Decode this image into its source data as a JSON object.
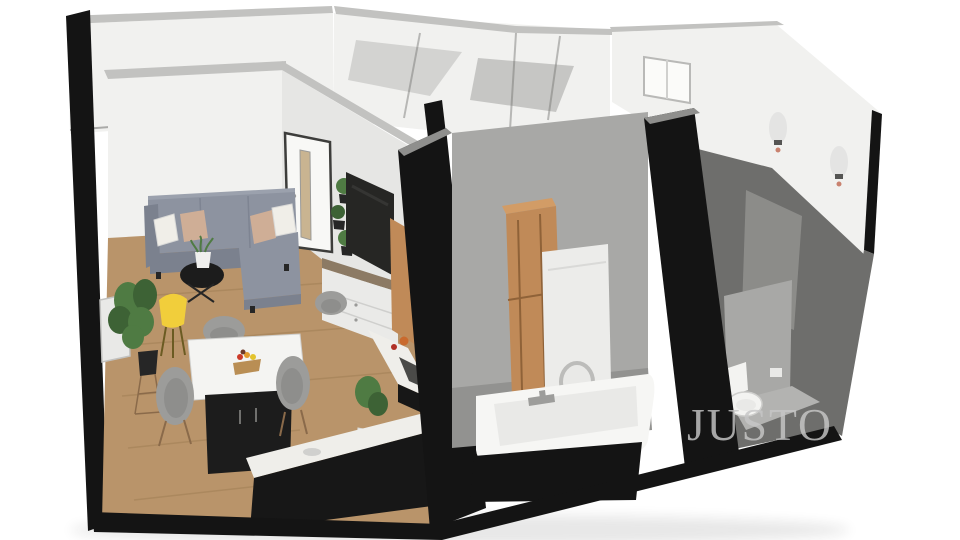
{
  "watermark": {
    "text": "JUSTO"
  },
  "palette": {
    "background": "#ffffff",
    "shadow_color": "#1a1a1a",
    "cut_black": "#141414",
    "wall_white": "#f1f1ef",
    "wall_white2": "#e6e6e4",
    "wall_top": "#c2c2c0",
    "wall_seam": "#70706e",
    "shadow_a": "#d3d3d1",
    "shadow_b": "#c6c6c4",
    "concrete_light": "#a8a8a6",
    "concrete_mid": "#8f8f8d",
    "concrete_dark": "#6e6e6c",
    "floor_wood": "#b9946a",
    "plank": "#9b7a50",
    "floor_gray": "#929290",
    "floor_gray_light": "#b3b3b1",
    "sofa": "#8d93a0",
    "sofa_dark": "#7b818e",
    "sofa_light": "#9ba1ad",
    "pillow_white": "#f0eee8",
    "pillow_tan": "#cfae96",
    "table_black": "#1c1c1c",
    "top_white": "#f4f4f2",
    "chair": "#9c9c9a",
    "chair_inner": "#8e8e8c",
    "leg_brown": "#8a6a4a",
    "lamp_yellow": "#f1ce3b",
    "lamp_leg": "#6b5b22",
    "plant": "#4f7b43",
    "plant_dark": "#3d6235",
    "pot_black": "#262626",
    "pot_white": "#efefed",
    "frame_light": "#e9e9e7",
    "door_white": "#f8f8f6",
    "door_frame": "#3d3d3b",
    "door_glass": "#c9b491",
    "tv": "#262624",
    "tv_sheen": "#3f3f3d",
    "dresser": "#eaeae8",
    "dresser_wood": "#8c7a64",
    "drawer_line": "#cfcfcd",
    "counter_white": "#efeeea",
    "counter_black": "#171717",
    "stove": "#4a4a48",
    "kettle": "#c96a2e",
    "jar_red": "#b03026",
    "cab_wood": "#c08a58",
    "cab_wood_light": "#d29c66",
    "cab_wood_dark": "#8f6238",
    "washer": "#ececea",
    "washer_shade": "#d9d9d7",
    "washer_ring": "#bcbcba",
    "tub": "#f6f6f4",
    "tub_inner": "#dededc",
    "chrome": "#9d9d9b",
    "toilet": "#f3f3f1",
    "sconce_glow": "#e3e3e1",
    "sconce_fix": "#555553",
    "sconce_dot": "#c9826f",
    "window_white": "#fbfbf9",
    "window_frame": "#b9b9b7",
    "mullion": "#d0d0ce",
    "knob": "#9a9a98",
    "fruit_red": "#cc3b2a",
    "fruit_orange": "#e39b2d",
    "fruit_yellow": "#e3c32d",
    "fruit_dark": "#703a28",
    "bowl": "#b98e54",
    "watermark_gray": "#c7c7c7"
  }
}
